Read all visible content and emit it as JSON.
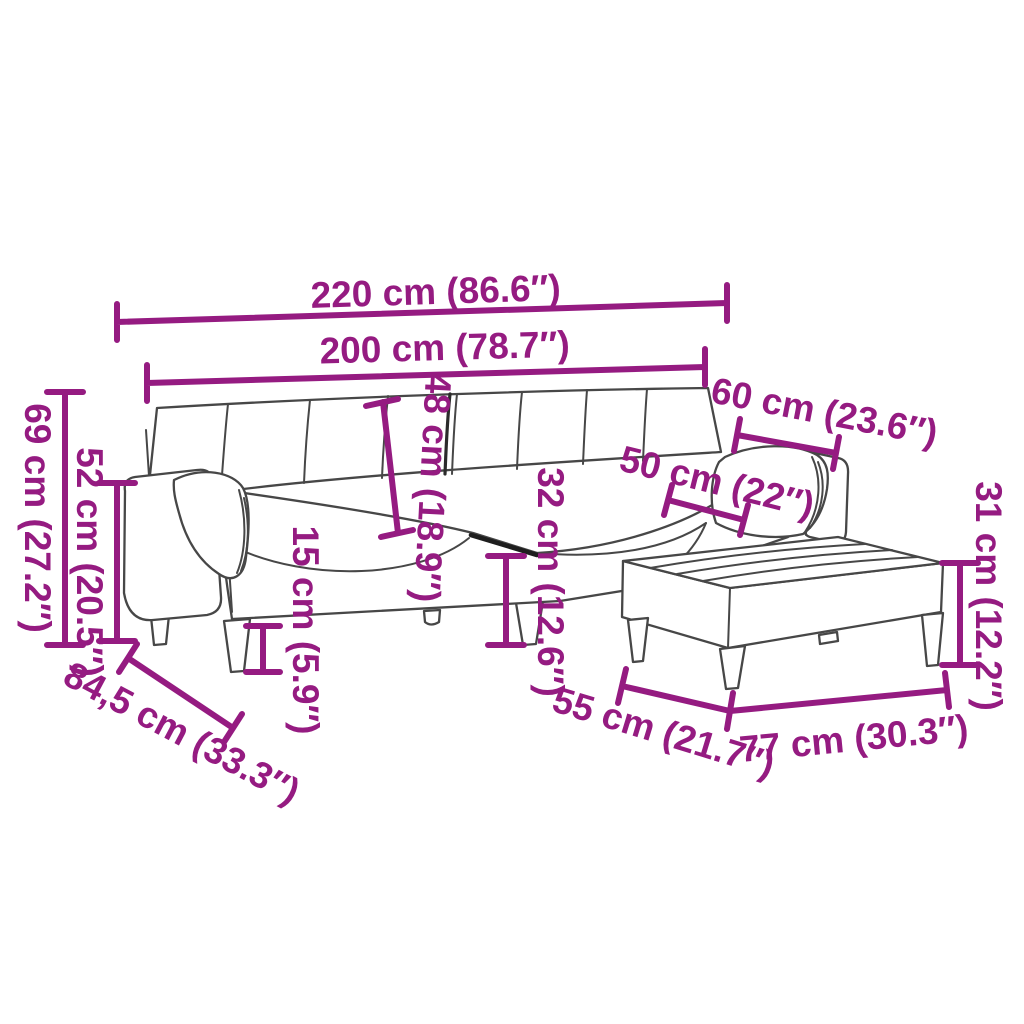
{
  "figure": {
    "kind": "sofa-bed-with-ottoman-dimension-diagram",
    "colors": {
      "dimension": "#951b81",
      "outline": "#474747",
      "background": "#ffffff"
    },
    "dims": {
      "d220": "220 cm (86.6″)",
      "d200": "200 cm (78.7″)",
      "d69": "69 cm (27.2″)",
      "d52": "52 cm (20.5″)",
      "d48": "48 cm (18.9″)",
      "d15": "15 cm (5.9″)",
      "d32": "32 cm (12.6″)",
      "d50": "50 cm (22″)",
      "d60": "60 cm (23.6″)",
      "d31": "31 cm (12.2″)",
      "d845": "84,5 cm (33.3″)",
      "d55": "55 cm (21.7″)",
      "d77": "77 cm (30.3″)"
    }
  }
}
